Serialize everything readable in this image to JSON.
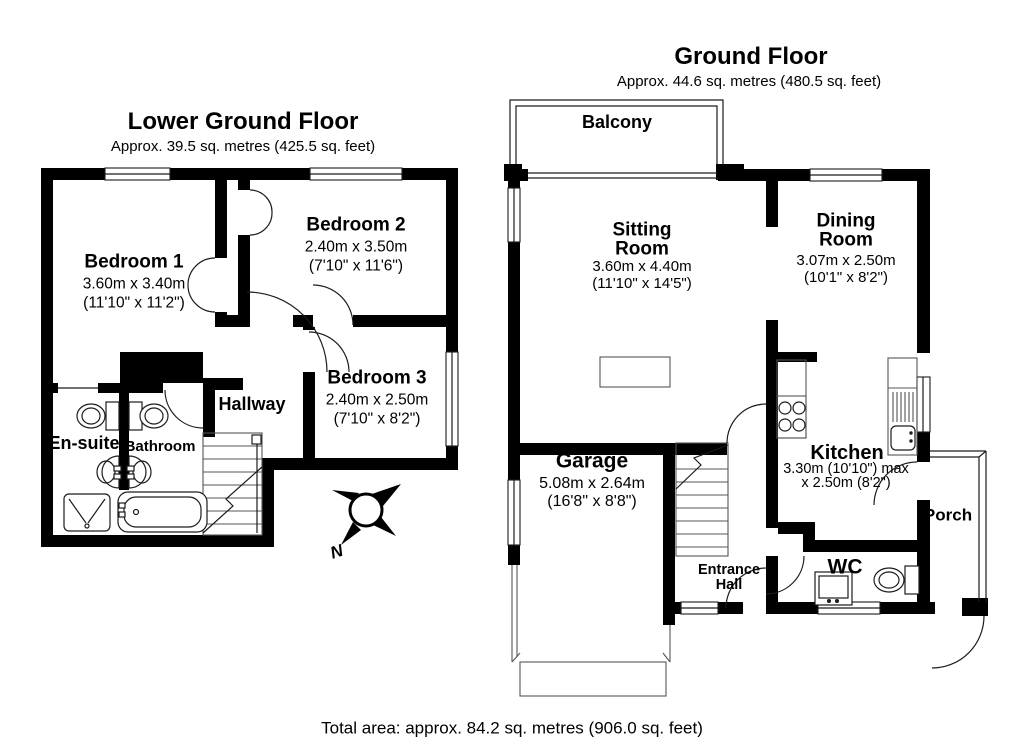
{
  "floors": {
    "lower_ground": {
      "title": "Lower Ground Floor",
      "area": "Approx. 39.5 sq. metres (425.5 sq. feet)",
      "rooms": {
        "bedroom1": {
          "name": "Bedroom 1",
          "metric": "3.60m x 3.40m",
          "imperial": "(11'10\" x 11'2\")"
        },
        "bedroom2": {
          "name": "Bedroom 2",
          "metric": "2.40m x 3.50m",
          "imperial": "(7'10\" x 11'6\")"
        },
        "bedroom3": {
          "name": "Bedroom 3",
          "metric": "2.40m x 2.50m",
          "imperial": "(7'10\" x 8'2\")"
        },
        "hallway": {
          "name": "Hallway"
        },
        "ensuite": {
          "name": "En-suite"
        },
        "bathroom": {
          "name": "Bathroom"
        }
      }
    },
    "ground": {
      "title": "Ground Floor",
      "area": "Approx. 44.6 sq. metres (480.5 sq. feet)",
      "rooms": {
        "balcony": {
          "name": "Balcony"
        },
        "sitting_room": {
          "name": "Sitting Room",
          "metric": "3.60m x 4.40m",
          "imperial": "(11'10\" x 14'5\")"
        },
        "dining_room": {
          "name": "Dining Room",
          "metric": "3.07m x 2.50m",
          "imperial": "(10'1\" x 8'2\")"
        },
        "garage": {
          "name": "Garage",
          "metric": "5.08m x 2.64m",
          "imperial": "(16'8\" x 8'8\")"
        },
        "kitchen": {
          "name": "Kitchen",
          "metric": "3.30m (10'10\") max",
          "imperial": "x 2.50m (8'2\")"
        },
        "entrance_hall": {
          "name": "Entrance Hall"
        },
        "wc": {
          "name": "WC"
        },
        "porch": {
          "name": "Porch"
        }
      }
    }
  },
  "compass": {
    "north_label": "N"
  },
  "footer": {
    "total_area": "Total area: approx. 84.2 sq. metres (906.0 sq. feet)"
  },
  "colors": {
    "wall": "#000000",
    "background": "#ffffff",
    "thin_line": "#1c1c1c"
  }
}
